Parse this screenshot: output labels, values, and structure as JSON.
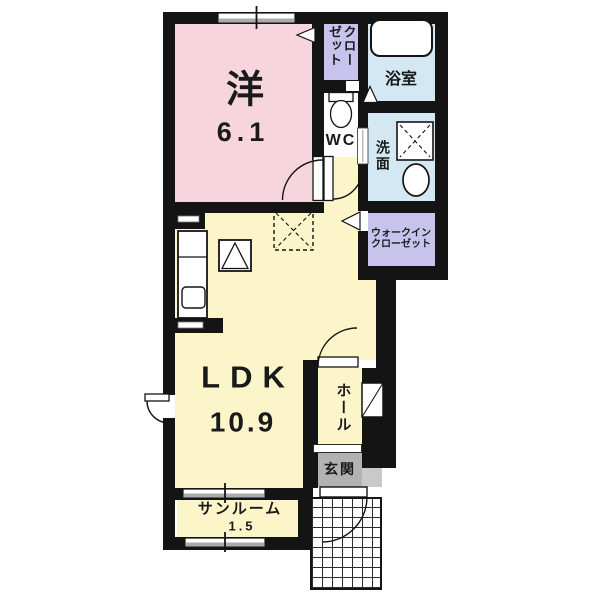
{
  "title": "1LDK apartment floor plan",
  "colors": {
    "pink": "#f6d5de",
    "yellow": "#fbf5c9",
    "blue": "#d3e8f3",
    "purple": "#c7c3ed",
    "wall": "#141414",
    "genkan_gray": "#b2b2b2",
    "step_gray": "#c9c9c9",
    "window_gray": "#ababab"
  },
  "rooms": {
    "western": {
      "name": "洋",
      "size": "6.1"
    },
    "closet": {
      "name": "クロー\nゼット"
    },
    "bathroom": {
      "name": "浴室"
    },
    "toilet": {
      "name": "WC"
    },
    "washroom": {
      "name": "洗面"
    },
    "walk_in_closet": {
      "name": "ウォークイン\nクローゼット"
    },
    "ldk": {
      "name": "LDK",
      "size": "10.9"
    },
    "hall": {
      "name": "ホール"
    },
    "entrance": {
      "name": "玄関"
    },
    "sunroom": {
      "name": "サンルーム",
      "size": "1.5"
    }
  }
}
